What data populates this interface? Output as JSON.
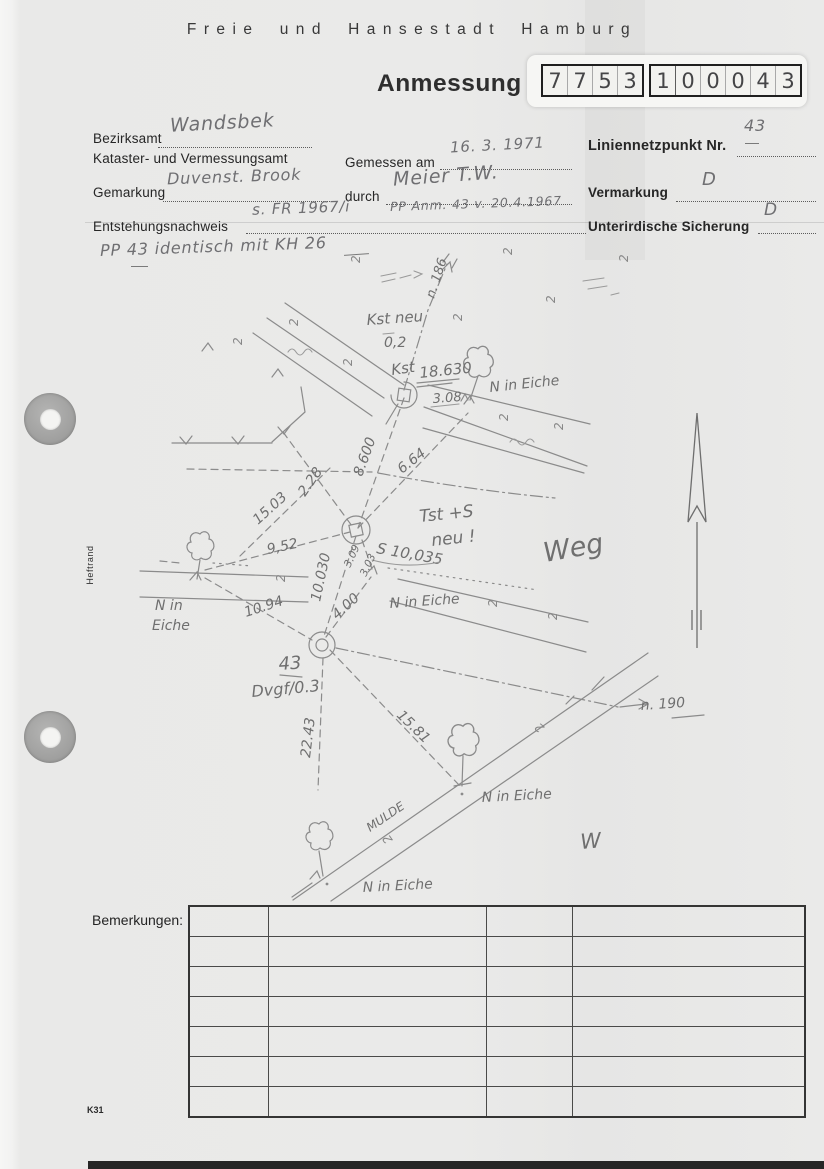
{
  "header": {
    "city": "Freie und Hansestadt Hamburg",
    "form_title": "Anmessung",
    "number_cells": [
      "7",
      "7",
      "5",
      "3",
      "1",
      "0",
      "0",
      "0",
      "4",
      "3"
    ]
  },
  "form": {
    "bezirksamt_label": "Bezirksamt",
    "bezirksamt_value": "Wandsbek",
    "amt_label": "Kataster- und Vermessungsamt",
    "gemessen_label": "Gemessen am",
    "gemessen_value": "16. 3. 1971",
    "liniennetzpunkt_label": "Liniennetzpunkt Nr.",
    "liniennetzpunkt_value": "43",
    "gemarkung_label": "Gemarkung",
    "gemarkung_value": "Duvenst. Brook",
    "durch_label": "durch",
    "durch_value": "Meier T.W.",
    "vermarkung_label": "Vermarkung",
    "vermarkung_value": "D",
    "entstehung_label": "Entstehungsnachweis",
    "entstehung_value_1": "s. FR 1967/i",
    "entstehung_value_2": "PP Anm. 43 v. 20.4.1967",
    "sicherung_label": "Unterirdische Sicherung",
    "sicherung_value": "D",
    "note": "PP 43 identisch mit KH 26"
  },
  "sketch": {
    "kst_neu": "Kst neu",
    "kst_neu_value": "0,2",
    "kst_label": "Kst",
    "kst_value": "18.630",
    "dist_308": "3.08",
    "n_in_eiche": "N in Eiche",
    "n_in": "N in",
    "eiche": "Eiche",
    "bearing_186": "n. 186",
    "bearing_190": "n. 190",
    "dist_8600": "8.600",
    "dist_664": "6.64",
    "dist_228": "2.28",
    "dist_1503": "15.03",
    "dist_952": "9,52",
    "dist_10030": "10.030",
    "dist_309a": "3.09",
    "dist_309b": "3.03",
    "s_value": "S 10,035",
    "tst_note_1": "Tst +S",
    "tst_note_2": "neu !",
    "weg": "Weg",
    "dist_400": "4.00",
    "dist_1094": "10.94",
    "point_43": "43",
    "dvgf": "Dvgf/0.3",
    "dist_2243": "22.43",
    "dist_1581": "15.81",
    "mulde": "MULDE",
    "w": "W",
    "grass": "2"
  },
  "margin": {
    "heftrand": "Heftrand"
  },
  "footer": {
    "bemerkungen_label": "Bemerkungen:",
    "form_code": "K31"
  },
  "remarks_table": {
    "rows": 7,
    "columns": 4
  }
}
